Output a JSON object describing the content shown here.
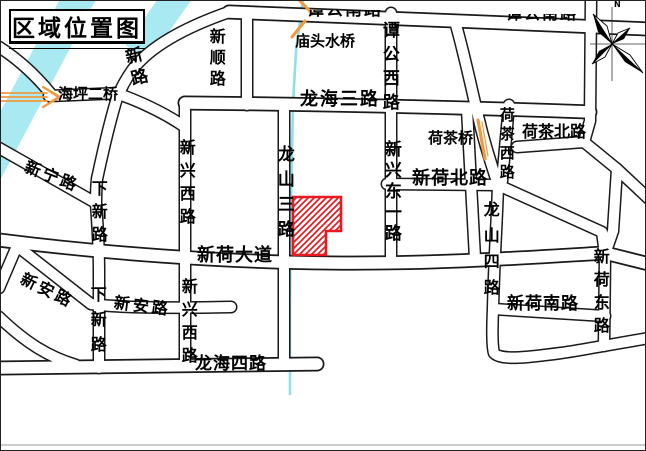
{
  "title": "区域位置图",
  "compass": {
    "north_label": "N"
  },
  "site": {
    "shape": "red-hatched-parcel"
  },
  "colors": {
    "site_red": "#e81a20",
    "water_cyan": "#a9e9f2",
    "stream_cyan": "#8fdfec",
    "bridge_orange": "#f0993f",
    "road_casing": "#1a1a1a",
    "road_fill": "#ffffff"
  },
  "labels": {
    "xin_lu": "新路",
    "haiping_bridge": "海坪二桥",
    "xinshun_lu": "新顺路",
    "miaotou_bridge": "庙头水桥",
    "tangong_nanlu_left": "谭公南路",
    "tangong_nanlu_right": "谭公南路",
    "tangong_xilu": "谭公西路",
    "longhai_3_lu": "龙海三路",
    "hecha_bridge": "荷茶桥",
    "hecha_xilu": "荷茶西路",
    "hecha_beilu": "荷茶北路",
    "xinhe_beilu": "新荷北路",
    "xinxing_dongyi_lu": "新兴东一路",
    "longshan_3_lu": "龙山三路",
    "xinhe_dadao": "新荷大道",
    "xinning_lu": "新宁路",
    "xiaxin_lu_upper": "下新路",
    "xinxing_xilu_upper": "新兴西路",
    "xinan_lu_diag": "新安路",
    "xinan_lu_mid": "新安路",
    "xiaxin_lu_lower": "下新路",
    "xinxing_xilu_lower": "新兴西路",
    "longhai_4_lu": "龙海四路",
    "longshan_4_lu": "龙山四路",
    "xinhe_nanlu": "新荷南路",
    "xinhe_donglu": "新荷东路"
  }
}
